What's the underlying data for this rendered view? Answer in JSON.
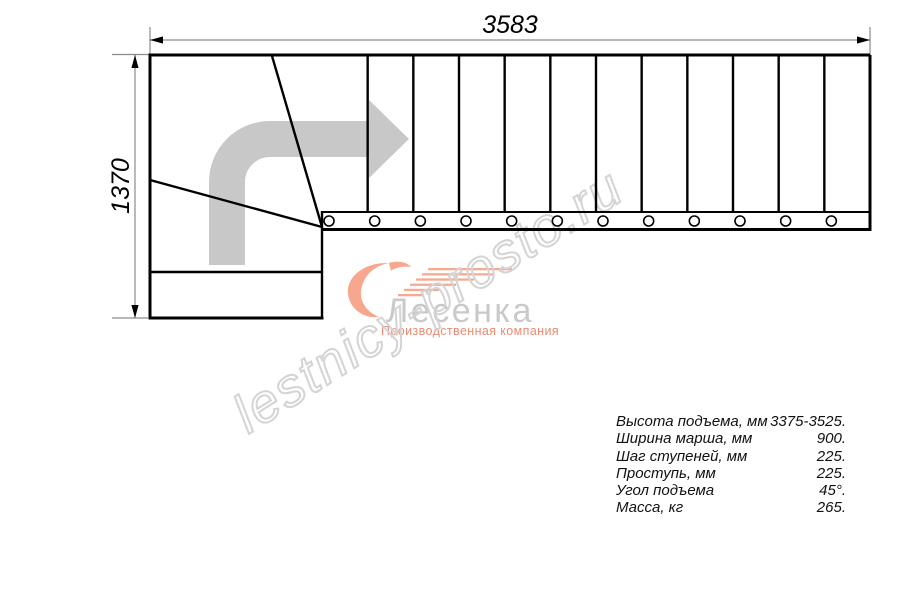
{
  "drawing": {
    "dim_width_label": "3583",
    "dim_height_label": "1370",
    "tread_count": 12,
    "baluster_count": 12
  },
  "logo": {
    "brand": "Лесенка",
    "tagline": "Производственная компания"
  },
  "watermark": {
    "text": "lestnicy-prosto.ru"
  },
  "specs": {
    "rows": [
      {
        "label": "Высота подъема, мм",
        "value": "3375-3525."
      },
      {
        "label": "Ширина марша, мм",
        "value": "900."
      },
      {
        "label": "Шаг ступеней, мм",
        "value": "225."
      },
      {
        "label": "Проступь, мм",
        "value": "225."
      },
      {
        "label": "Угол подъема",
        "value": "45°."
      },
      {
        "label": "Масса, кг",
        "value": "265."
      }
    ]
  },
  "colors": {
    "outline": "#000000",
    "dimension_line": "#8c8c8c",
    "direction_arrow": "#c8c8c8",
    "watermark_stroke": "#d4d4d4",
    "brand_gray": "#c9c9c9",
    "salmon": "#ed8a74"
  }
}
